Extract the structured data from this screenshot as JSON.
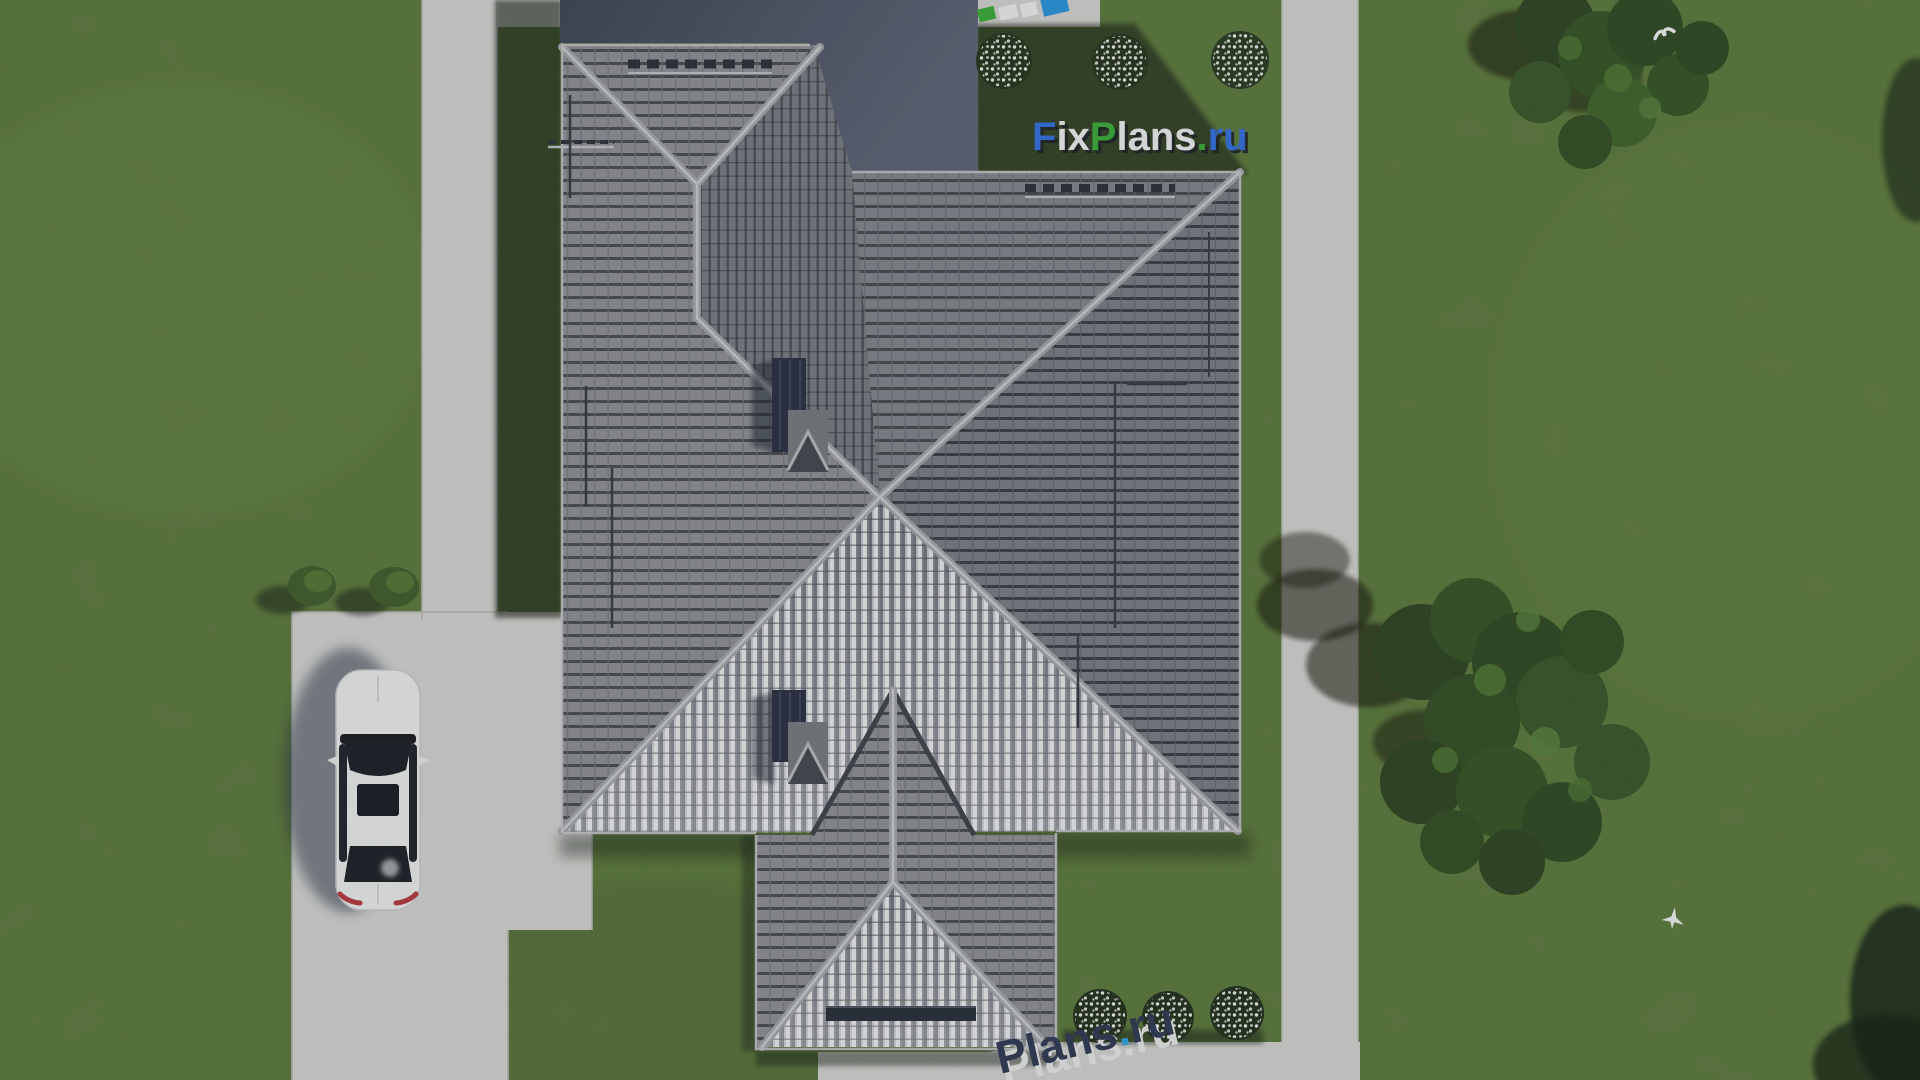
{
  "branding": {
    "main_watermark": {
      "text": "FixPlans.ru",
      "segments": [
        {
          "text": "F",
          "color": "#2d6de3"
        },
        {
          "text": "ix",
          "color": "#f2f3f4"
        },
        {
          "text": "P",
          "color": "#35ad35"
        },
        {
          "text": "lans",
          "color": "#f2f3f4"
        },
        {
          "text": ".",
          "color": "#35ad35"
        },
        {
          "text": "ru",
          "color": "#2d6de3"
        }
      ]
    },
    "bottom_watermark": {
      "text": "Plans.ru",
      "segments": [
        {
          "text": "Plans",
          "color": "#2b3450"
        },
        {
          "text": ".",
          "color": "#29a7e8"
        },
        {
          "text": "ru",
          "color": "#2b3450"
        }
      ]
    },
    "top_edge_tiles": [
      "#35ad35",
      "#f2f3f4",
      "#f2f3f4",
      "#2196e0"
    ]
  },
  "scene": {
    "car_color": "#f1f2f2",
    "chimney_count": 2,
    "bird_count": 2,
    "bush_flower_color": "#ffffff"
  },
  "palette": {
    "grass": "#5f7d3b",
    "grass_shadow": "#22351a",
    "pavement": "#d7d8d5",
    "roof_tile": "#8d9097",
    "roof_row_line": "#45494f",
    "roof_dark_plane": "#485064",
    "roof_bright_rib": "#e9ebed",
    "ridge_cap": "#a4a7ac",
    "chimney_dark": "#232b3d"
  }
}
